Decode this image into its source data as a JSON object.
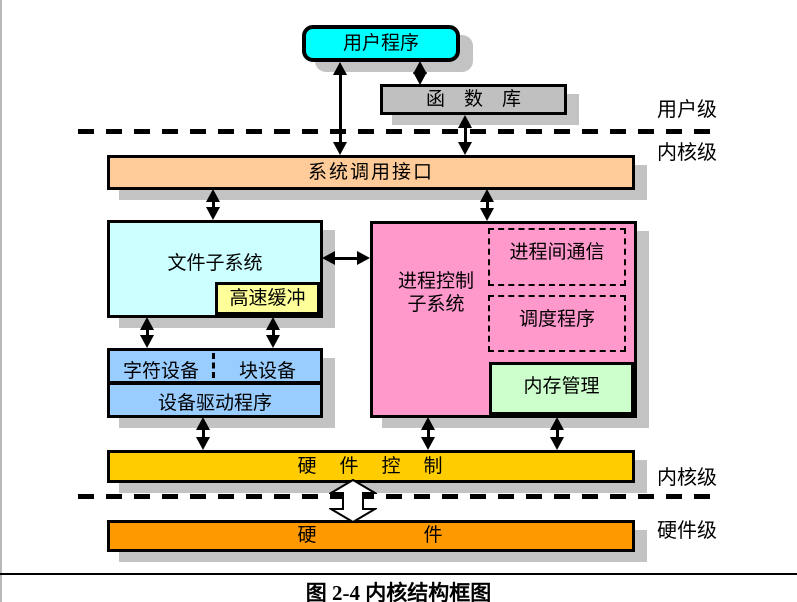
{
  "figure": {
    "caption": "图 2-4 内核结构框图"
  },
  "levels": {
    "user_level": "用户级",
    "kernel_level_top": "内核级",
    "kernel_level_bottom": "内核级",
    "hardware_level": "硬件级"
  },
  "boxes": {
    "user_program": "用户程序",
    "function_library": "函　数　库",
    "syscall_interface": "系统调用接口",
    "file_subsystem": "文件子系统",
    "buffer_cache": "高速缓冲",
    "process_control_line1": "进程控制",
    "process_control_line2": "子系统",
    "ipc": "进程间通信",
    "scheduler": "调度程序",
    "memory_management": "内存管理",
    "char_device": "字符设备",
    "block_device": "块设备",
    "device_driver": "设备驱动程序",
    "hardware_control": "硬　件　控　制",
    "hardware": "硬　　　　　件"
  },
  "colors": {
    "user_program": "#00FFFF",
    "function_library": "#C0C0C0",
    "syscall_interface": "#FFCC99",
    "file_subsystem": "#CCFFFF",
    "buffer_cache": "#FFFF99",
    "process_control": "#FF99CC",
    "memory_management": "#CCFFCC",
    "device": "#99CCFF",
    "hardware_control": "#FFCC00",
    "hardware": "#FF9900",
    "shadow": "#C3C3C3",
    "border": "#000000"
  }
}
